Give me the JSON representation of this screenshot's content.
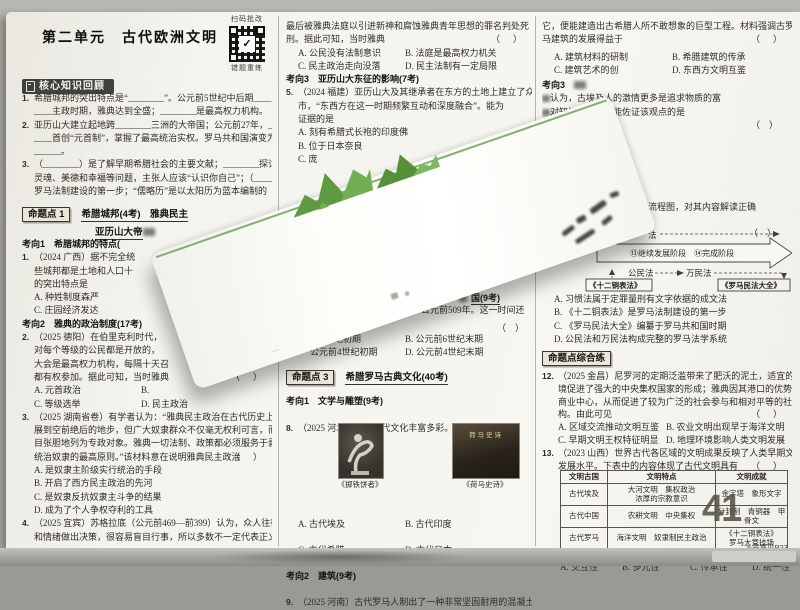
{
  "ui": {
    "bracket": "（　）"
  },
  "header": {
    "unit_title": "第二单元　古代欧洲文明",
    "qr_label_top": "扫码批改",
    "qr_label_bottom": "错题重练"
  },
  "left": {
    "review_title": "核心知识回顾",
    "fill": {
      "q1n": "1.",
      "q1l1": "希腊城邦的突出特点是“________”。公元前5世纪中后期____",
      "q1l2": "____主政时期，雅典达到全盛；________是最高权力机构。",
      "q2n": "2.",
      "q2l1": "亚历山大建立起地跨________三洲的大帝国；公元前27年，____",
      "q2l2": "____首创“元首制”，掌握了最高统治实权。罗马共和国演变为__",
      "q2l3": "______。",
      "q3n": "3.",
      "q3l1": "（________）是了解早期希腊社会的主要文献；________探讨人的",
      "q3l2": "灵魂、美德和幸福等问题，主张人应该“认识你自己”；（______）是",
      "q3l3": "罗马法制建设的第一步；“儒略历”是以太阳历为蓝本编制的"
    },
    "mtd1": {
      "badge": "命题点 1",
      "title": "希腊城邦(4考)　雅典民主",
      "line2": "亚历山大帝"
    },
    "kx1": "考向1　希腊城邦的特点(",
    "q1": {
      "n": "1.",
      "l1": "（2024 广西）据不完全统",
      "l2": "些城邦都是土地和人口十",
      "l3": "的突出特点是",
      "A": "A. 种姓制度森严",
      "C": "C. 庄园经济发达"
    },
    "kx2": "考向2　雅典的政治制度(17考)",
    "q2": {
      "n": "2.",
      "l1": "（2025 德阳）在伯里克利时代，",
      "l2": "对每个等级的公民都是开放的，",
      "l3": "大会是最高权力机构，每隔十天召",
      "l4": "都有权参加。据此可知，当时雅典",
      "A": "A. 元首政治",
      "B": "B.",
      "C": "C. 等级选举",
      "D": "D. 民主政治"
    },
    "q3": {
      "n": "3.",
      "l1": "（2025 湖南省卷）有学者认为：“雅典民主政治在古代历史上确实发",
      "l2": "展到空前绝后的地步，但广大奴隶群众不仅毫无权利可言，而且被明",
      "l3": "目张胆地列为专政对象。雅典一切法制、政策都必须服务于剥削与",
      "l4": "统治奴隶的最高原则。”该材料意在说明雅典民主政治",
      "A": "A. 是奴隶主阶级实行统治的手段",
      "B": "B. 开启了西方民主政治的先河",
      "C": "C. 是奴隶反抗奴隶主斗争的结果",
      "D": "D. 成为了个人争权夺利的工具"
    },
    "q4": {
      "n": "4.",
      "l1": "（2025 宜宾）苏格拉底（公元前469—前399）认为，众人往往凭感觉",
      "l2": "和情绪做出决策，很容易盲目行事，所以多数不一定代表正义。他"
    }
  },
  "mid": {
    "cont": {
      "l1": "最后被雅典法庭以引进新神和腐蚀雅典青年思想的罪名判处死",
      "l2": "刑。据此可知，当时雅典",
      "A": "A. 公民没有法制意识",
      "B": "B. 法庭是最高权力机关",
      "C": "C. 民主政治走向没落",
      "D": "D. 民主法制有一定局限"
    },
    "kx3": "考向3　亚历山大东征的影响(7考)",
    "q5": {
      "n": "5.",
      "l1": "（2024 福建）亚历山大及其继承者在东方的土地上建立了众多的城",
      "l2": "市，“东西方在这一时期频繁互动和深度融合”。能为",
      "l3": "证据的是",
      "A": "A. 刻有希腊式长袍的印度佛",
      "B": "B. 位于日本奈良",
      "C": "C. 庞"
    },
    "frag": {
      "head": "国(9考)",
      "l1": "公元前509年。这一时间还",
      "A": "纪初期",
      "B": "B. 公元前6世纪末期",
      "C": "公元前4世纪初期",
      "D": "D. 公元前4世纪末期"
    },
    "mtd3": {
      "badge": "命题点 3",
      "title": "希腊罗马古典文化(40考)"
    },
    "kxw1": "考向1　文学与雕塑(9考)",
    "q8": {
      "n": "8.",
      "l1": "（2025 河北）世界古代文化丰富多彩。下列作品均出自",
      "caption1": "《掷铁饼者》",
      "caption2": "《荷马史诗》",
      "book_title": "荷马史诗",
      "A": "A. 古代埃及",
      "B": "B. 古代印度",
      "C": "C. 古代希腊",
      "D": "D. 古代日本"
    },
    "kxw2": "考向2　建筑(9考)",
    "q9": {
      "n": "9.",
      "l1": "（2025 河南）古代罗马人制出了一种非常坚固耐用的混凝土，有了"
    }
  },
  "right": {
    "cont": {
      "l1": "它，便能建造出古希腊人所不敢想象的巨型工程。材料强调古罗",
      "l2": "马建筑的发展得益于",
      "A": "A. 建筑材料的研制",
      "B": "B. 希腊建筑的传承",
      "C": "C. 建筑艺术的创",
      "D": "D. 东西方文明互鉴"
    },
    "kx3b": "考向3",
    "q10": {
      "l1": "认为，古埃及人的激情更多是追求物质的富",
      "l2": "对知识的热爱。能佐证该观点的是"
    },
    "q11": {
      "frag": "演变”流程图，对其内容解读正确",
      "flow": {
        "fa": "法",
        "stage": "⑬继续发展阶段　⑭完成阶段",
        "gongminfa": "公民法",
        "wanminfa": "万民法",
        "box1": "《十二铜表法》",
        "box2": "《罗马民法大全》"
      },
      "A": "A. 习惯法属于定罪量刑有文字依据的成文法",
      "B": "B. 《十二铜表法》是罗马法制建设的第一步",
      "C": "C. 《罗马民法大全》编纂于罗马共和国时期",
      "D": "D. 公民法和万民法构成完整的罗马法学系统"
    },
    "zh_badge": "命题点综合练",
    "q12": {
      "n": "12.",
      "l1": "（2025 金昌）尼罗河的定期泛滥带来了肥沃的泥土，适宜的农业环",
      "l2": "境促进了强大的中央集权国家的形成；雅典因其港口的优势成为",
      "l3": "商业中心，从而促进了较为广泛的社会参与和相对平等的社会结",
      "l4": "构。由此可见",
      "A": "A. 区域交流推动文明互鉴",
      "B": "B. 农业文明出现早于海洋文明",
      "C": "C. 早期文明王权特征明显",
      "D": "D. 地理环境影响人类文明发展"
    },
    "q13": {
      "n": "13.",
      "l1": "（2023 山西）世界古代各区域的文明成果反映了人类早期文明的",
      "l2": "发展水平。下表中的内容体现了古代文明具有",
      "table": {
        "headers": [
          "文明古国",
          "文明特点",
          "文明成就"
        ],
        "rows": [
          {
            "country": "古代埃及",
            "trait": "大河文明　集权政治",
            "trait2": "浓厚的宗教意识",
            "achieve": "金字塔　象形文字"
          },
          {
            "country": "古代中国",
            "trait": "农耕文明　中央集权",
            "achieve": "分封制　青铜器　甲骨文"
          },
          {
            "country": "古代罗马",
            "trait": "海洋文明　奴隶制民主政治",
            "achieve": "《十二铜表法》",
            "achieve2": "罗马大竞技场"
          }
        ]
      },
      "optA": "A. 交互性",
      "optB": "B. 多元性",
      "optC": "C. 传承性",
      "optD": "D. 统一性"
    },
    "answer_ref": "答案见P23",
    "watermark": "41"
  }
}
